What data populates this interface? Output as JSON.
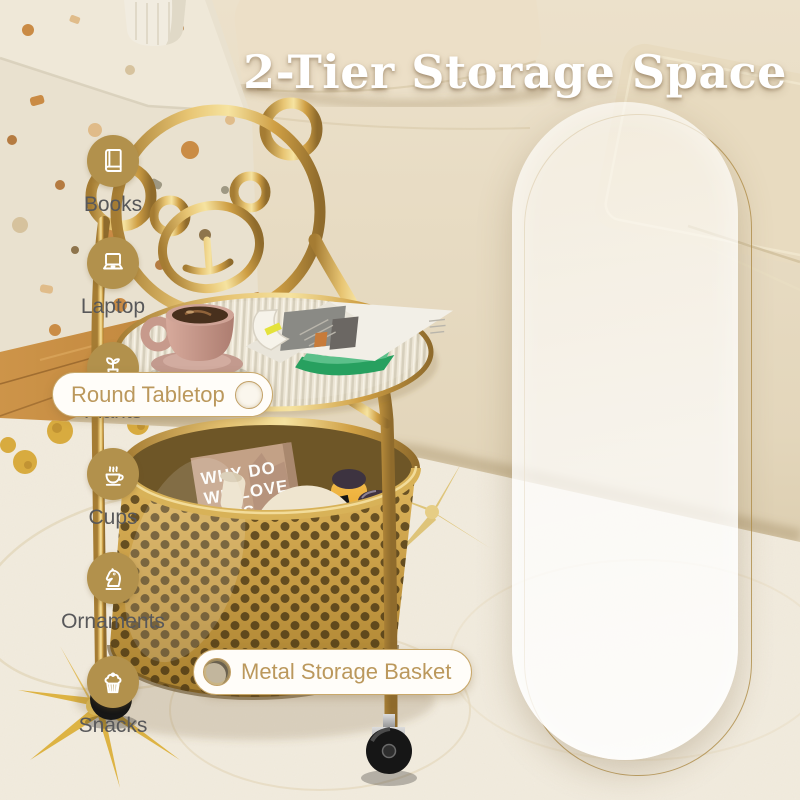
{
  "title": "2-Tier Storage Space",
  "callouts": {
    "tabletop": "Round Tabletop",
    "basket": "Metal Storage Basket"
  },
  "panel": {
    "items": [
      {
        "icon": "book-icon",
        "label": "Books"
      },
      {
        "icon": "laptop-icon",
        "label": "Laptop"
      },
      {
        "icon": "plant-icon",
        "label": "Plants"
      },
      {
        "icon": "coffee-cup-icon",
        "label": "Cups"
      },
      {
        "icon": "chess-knight-icon",
        "label": "Ornaments"
      },
      {
        "icon": "cupcake-icon",
        "label": "Snacks"
      }
    ]
  },
  "props": {
    "book": {
      "line1": "WHY DO",
      "line2": "WE LOVE",
      "line3": "CATS"
    },
    "bag_brand": "BLANCHARD'S"
  },
  "colors": {
    "icon_circle_gold": "#b2914c",
    "metal_gold": "#c9a049",
    "callout_text_gold": "#bb985c",
    "panel_label_gray": "#58585a",
    "title_white": "#ffffff",
    "room_cream": "#e8ddc6",
    "rug_cream": "#f2ecdf",
    "juice_orange": "#efa62f"
  }
}
